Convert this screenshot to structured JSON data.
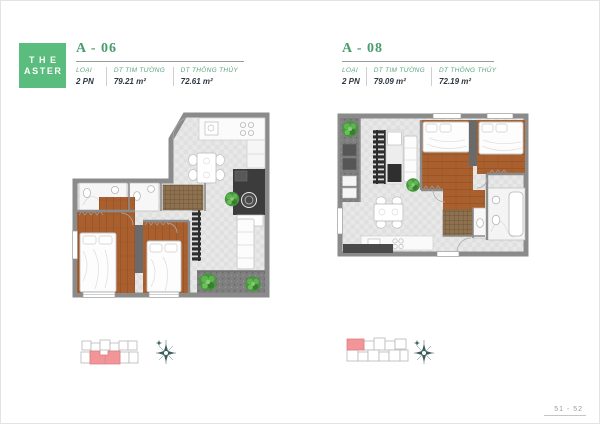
{
  "logo": {
    "line1": "THE",
    "line2": "ASTER"
  },
  "units": [
    {
      "title": "A - 06",
      "specs": [
        {
          "label": "LOẠI",
          "value": "2 PN"
        },
        {
          "label": "DT TIM TƯỜNG",
          "value": "79.21 m²"
        },
        {
          "label": "DT THÔNG THỦY",
          "value": "72.61 m²"
        }
      ]
    },
    {
      "title": "A - 08",
      "specs": [
        {
          "label": "LOẠI",
          "value": "2 PN"
        },
        {
          "label": "DT TIM TƯỜNG",
          "value": "79.09 m²"
        },
        {
          "label": "DT THÔNG THỦY",
          "value": "72.19 m²"
        }
      ]
    }
  ],
  "page": {
    "number": "51 - 52"
  },
  "icons": {
    "compass": "compass-rose",
    "plant": "shrub"
  },
  "colors": {
    "brand_green": "#5abd7d",
    "title_green": "#479c6d",
    "label_green": "#5aa57e",
    "value_dark": "#2e3740",
    "wall_grey": "#8b8b8b",
    "wood_floor": "#a9602e",
    "tile_floor": "#e8e8e8",
    "dark_fixture": "#3c3c3c",
    "plant_green": "#48963f",
    "keyplan_highlight_pink": "#f29598",
    "compass_teal": "#3a5f5b",
    "page_number_grey": "#9b9b9b"
  }
}
